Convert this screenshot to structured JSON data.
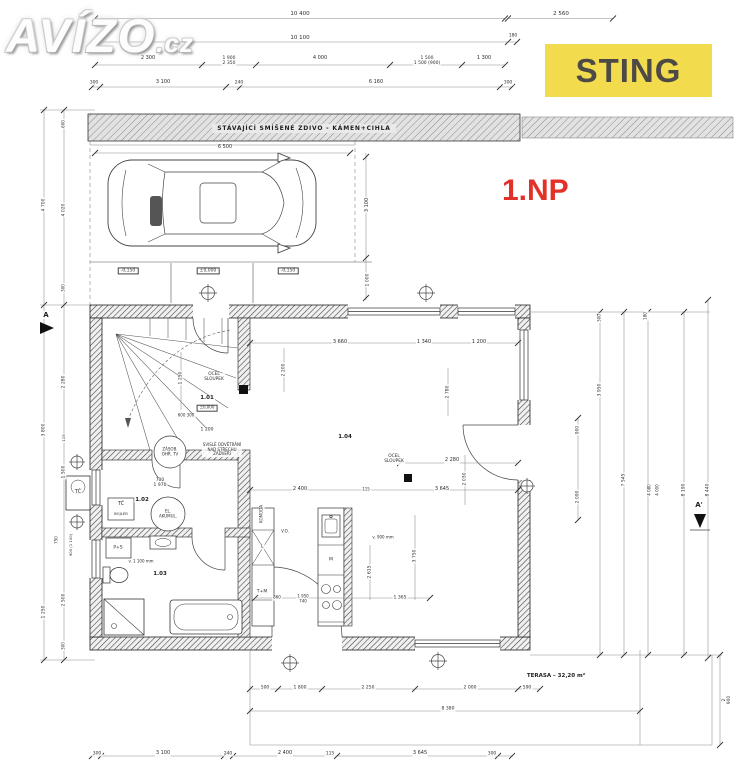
{
  "watermark": {
    "main": "AVÍZO",
    "tld": ".cz"
  },
  "badge": {
    "label": "STING",
    "bg": "#F2DC4E",
    "fg": "#4D4A45"
  },
  "floor_label": {
    "text": "1.NP",
    "color": "#E23128"
  },
  "band": {
    "text": "STÁVAJÍCÍ SMÍŠENÉ ZDIVO - KÁMEN+CIHLA"
  },
  "terrace": {
    "label": "TERASA – 32,20 m²"
  },
  "labels": [
    {
      "t": "10 400",
      "x": 300,
      "y": 14
    },
    {
      "t": "2 560",
      "x": 561,
      "y": 14
    },
    {
      "t": "10 100",
      "x": 300,
      "y": 38
    },
    {
      "t": "180",
      "x": 513,
      "y": 36,
      "s": 4.5
    },
    {
      "t": "2 300",
      "x": 148,
      "y": 59,
      "s": 5
    },
    {
      "t": "1 900\n2 350",
      "x": 229,
      "y": 61,
      "s": 4.5
    },
    {
      "t": "4 000",
      "x": 320,
      "y": 59,
      "s": 5
    },
    {
      "t": "1 500\n1 500 (900)",
      "x": 427,
      "y": 61,
      "s": 4.5
    },
    {
      "t": "1 300",
      "x": 484,
      "y": 59,
      "s": 5
    },
    {
      "t": "300",
      "x": 94,
      "y": 83,
      "s": 4.5
    },
    {
      "t": "3 100",
      "x": 163,
      "y": 83,
      "s": 5
    },
    {
      "t": "240",
      "x": 239,
      "y": 83,
      "s": 4.5
    },
    {
      "t": "6 160",
      "x": 376,
      "y": 83,
      "s": 5
    },
    {
      "t": "300",
      "x": 508,
      "y": 83,
      "s": 4.5
    },
    {
      "t": "6 500",
      "x": 225,
      "y": 148,
      "s": 5
    },
    {
      "t": "3 100",
      "x": 368,
      "y": 205,
      "r": -90,
      "s": 5
    },
    {
      "t": "1 000",
      "x": 368,
      "y": 280,
      "r": -90,
      "s": 4.5
    },
    {
      "t": "-0,150",
      "x": 128,
      "y": 271,
      "box": true,
      "s": 4.5
    },
    {
      "t": "±0,000",
      "x": 208,
      "y": 271,
      "box": true,
      "s": 4.5
    },
    {
      "t": "-0,150",
      "x": 288,
      "y": 271,
      "box": true,
      "s": 4.5
    },
    {
      "t": "3 660",
      "x": 340,
      "y": 343,
      "s": 5
    },
    {
      "t": "1 340",
      "x": 424,
      "y": 343,
      "s": 5
    },
    {
      "t": "1 200",
      "x": 479,
      "y": 343,
      "s": 5
    },
    {
      "t": "2 200",
      "x": 284,
      "y": 370,
      "r": -90,
      "s": 4.5
    },
    {
      "t": "2 780",
      "x": 448,
      "y": 392,
      "r": -90,
      "s": 4.5
    },
    {
      "t": "OCEL\nSLOUPEK",
      "x": 214,
      "y": 378,
      "s": 4.3
    },
    {
      "t": "1.01",
      "x": 207,
      "y": 398,
      "b": true,
      "s": 5.5,
      "n": "room-label"
    },
    {
      "t": "±0,000",
      "x": 207,
      "y": 408,
      "box": true,
      "s": 4
    },
    {
      "t": "600  300",
      "x": 186,
      "y": 416,
      "s": 4
    },
    {
      "t": "1 200",
      "x": 207,
      "y": 430,
      "s": 4.5
    },
    {
      "t": "1 250",
      "x": 181,
      "y": 378,
      "r": -90,
      "s": 4.5
    },
    {
      "t": "SVISLÉ ODVĚTRÁNÍ\nNAD STŘECHU\nZÁDVEŘÍ",
      "x": 222,
      "y": 450,
      "s": 4
    },
    {
      "t": "ZÁSOB.\nOHŘ. TV",
      "x": 170,
      "y": 452,
      "s": 4
    },
    {
      "t": "700\n1 970",
      "x": 160,
      "y": 483,
      "s": 4.5
    },
    {
      "t": "1.02",
      "x": 142,
      "y": 500,
      "b": true,
      "s": 5.5,
      "n": "room-label"
    },
    {
      "t": "TČ",
      "x": 121,
      "y": 505,
      "s": 5
    },
    {
      "t": "BOJLER",
      "x": 121,
      "y": 514,
      "s": 3.8
    },
    {
      "t": "EL.\nAKUMUL.",
      "x": 168,
      "y": 514,
      "s": 4
    },
    {
      "t": "TČ",
      "x": 78,
      "y": 493,
      "s": 5
    },
    {
      "t": "P+S",
      "x": 118,
      "y": 548,
      "s": 4.5
    },
    {
      "t": "v. 1 100 mm",
      "x": 141,
      "y": 562,
      "s": 4
    },
    {
      "t": "1.03",
      "x": 160,
      "y": 574,
      "b": true,
      "s": 5.5,
      "n": "room-label"
    },
    {
      "t": "KOMODA",
      "x": 262,
      "y": 514,
      "r": -90,
      "s": 4
    },
    {
      "t": "V.O.",
      "x": 285,
      "y": 532,
      "s": 4
    },
    {
      "t": "L",
      "x": 262,
      "y": 547,
      "s": 4.5
    },
    {
      "t": "T+M",
      "x": 262,
      "y": 592,
      "s": 4.5
    },
    {
      "t": "M",
      "x": 331,
      "y": 560,
      "s": 4.5
    },
    {
      "t": "v. 900 mm",
      "x": 383,
      "y": 538,
      "s": 4
    },
    {
      "t": "860",
      "x": 277,
      "y": 598,
      "s": 4
    },
    {
      "t": "1 950\n740",
      "x": 303,
      "y": 599,
      "s": 4
    },
    {
      "t": "1 365",
      "x": 400,
      "y": 598,
      "s": 4.5
    },
    {
      "t": "2 615",
      "x": 370,
      "y": 572,
      "r": -90,
      "s": 4.5
    },
    {
      "t": "3 750",
      "x": 415,
      "y": 556,
      "r": -90,
      "s": 4.5
    },
    {
      "t": "1.04",
      "x": 345,
      "y": 437,
      "b": true,
      "s": 5.5,
      "n": "room-label"
    },
    {
      "t": "OCEL\nSLOUPEK",
      "x": 394,
      "y": 460,
      "s": 4.3
    },
    {
      "t": "2 280",
      "x": 452,
      "y": 461,
      "s": 5
    },
    {
      "t": "2 030",
      "x": 465,
      "y": 479,
      "r": -90,
      "s": 4.5
    },
    {
      "t": "2 400",
      "x": 300,
      "y": 490,
      "s": 5
    },
    {
      "t": "115",
      "x": 366,
      "y": 490,
      "s": 4
    },
    {
      "t": "3 645",
      "x": 442,
      "y": 490,
      "s": 5
    },
    {
      "t": "500",
      "x": 265,
      "y": 688,
      "s": 4.5
    },
    {
      "t": "1 800",
      "x": 300,
      "y": 688,
      "s": 4.5
    },
    {
      "t": "2 250",
      "x": 368,
      "y": 688,
      "s": 4.5
    },
    {
      "t": "2 000",
      "x": 470,
      "y": 688,
      "s": 4.5
    },
    {
      "t": "590",
      "x": 527,
      "y": 688,
      "s": 4.5
    },
    {
      "t": "8 380",
      "x": 448,
      "y": 709,
      "s": 4.5
    },
    {
      "t": "300",
      "x": 97,
      "y": 754,
      "s": 4.5
    },
    {
      "t": "3 100",
      "x": 163,
      "y": 754,
      "s": 5
    },
    {
      "t": "240",
      "x": 228,
      "y": 754,
      "s": 4.5
    },
    {
      "t": "2 400",
      "x": 285,
      "y": 754,
      "s": 5
    },
    {
      "t": "115",
      "x": 330,
      "y": 754,
      "s": 4.5
    },
    {
      "t": "3 645",
      "x": 420,
      "y": 754,
      "s": 5
    },
    {
      "t": "300",
      "x": 492,
      "y": 754,
      "s": 4.5
    },
    {
      "t": "900",
      "x": 578,
      "y": 430,
      "r": -90,
      "s": 4.5
    },
    {
      "t": "2 090",
      "x": 578,
      "y": 497,
      "r": -90,
      "s": 4.5
    },
    {
      "t": "300",
      "x": 600,
      "y": 318,
      "r": -90,
      "s": 4
    },
    {
      "t": "3 950",
      "x": 600,
      "y": 390,
      "r": -90,
      "s": 4.5
    },
    {
      "t": "180",
      "x": 646,
      "y": 316,
      "r": -90,
      "s": 4
    },
    {
      "t": "7 545",
      "x": 624,
      "y": 480,
      "r": -90,
      "s": 4.5
    },
    {
      "t": "4 080",
      "x": 650,
      "y": 490,
      "r": -90,
      "s": 4
    },
    {
      "t": "4 000",
      "x": 658,
      "y": 490,
      "r": -90,
      "s": 4
    },
    {
      "t": "8 190",
      "x": 684,
      "y": 490,
      "r": -90,
      "s": 4.5
    },
    {
      "t": "8 440",
      "x": 708,
      "y": 490,
      "r": -90,
      "s": 4.5
    },
    {
      "t": "2 900",
      "x": 727,
      "y": 700,
      "r": -90,
      "s": 4.5
    },
    {
      "t": "4 700",
      "x": 44,
      "y": 205,
      "r": -90,
      "s": 4.5
    },
    {
      "t": "3 800",
      "x": 44,
      "y": 430,
      "r": -90,
      "s": 4.5
    },
    {
      "t": "1 250",
      "x": 44,
      "y": 612,
      "r": -90,
      "s": 4.5
    },
    {
      "t": "600",
      "x": 64,
      "y": 124,
      "r": -90,
      "s": 4
    },
    {
      "t": "4 020",
      "x": 64,
      "y": 210,
      "r": -90,
      "s": 4.5
    },
    {
      "t": "300",
      "x": 64,
      "y": 288,
      "r": -90,
      "s": 4
    },
    {
      "t": "2 280",
      "x": 64,
      "y": 382,
      "r": -90,
      "s": 4.5
    },
    {
      "t": "115",
      "x": 64,
      "y": 438,
      "r": -90,
      "s": 3.8
    },
    {
      "t": "1 500",
      "x": 64,
      "y": 472,
      "r": -90,
      "s": 4.5
    },
    {
      "t": "750",
      "x": 57,
      "y": 540,
      "r": -90,
      "s": 4
    },
    {
      "t": "900 (1 100)",
      "x": 71,
      "y": 545,
      "r": -90,
      "s": 3.8
    },
    {
      "t": "2 500",
      "x": 64,
      "y": 600,
      "r": -90,
      "s": 4.5
    },
    {
      "t": "300",
      "x": 64,
      "y": 646,
      "r": -90,
      "s": 4
    },
    {
      "t": "A",
      "x": 46,
      "y": 315,
      "b": true,
      "s": 7,
      "n": "section-marker-a"
    },
    {
      "t": "A'",
      "x": 699,
      "y": 505,
      "b": true,
      "s": 7,
      "n": "section-marker-a-prime"
    }
  ]
}
